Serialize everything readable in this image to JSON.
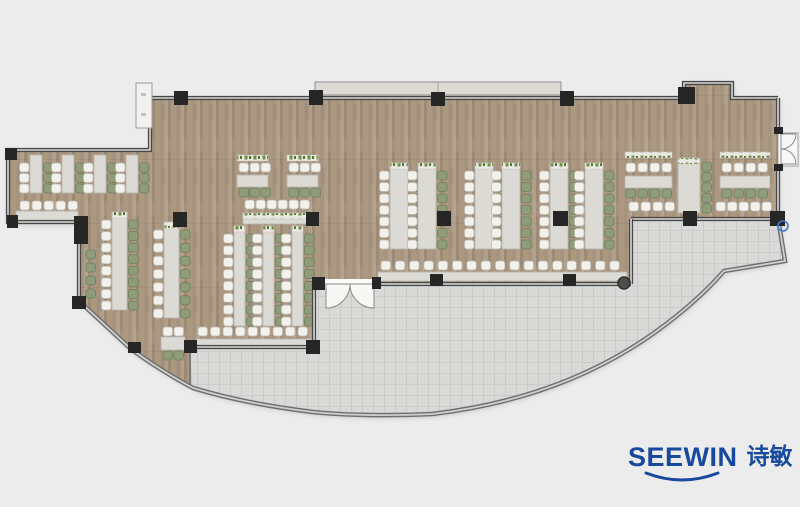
{
  "logo": {
    "brand": "SEEWIN",
    "brand_cn": "诗敏",
    "color": "#17499E"
  },
  "floorplan": {
    "width": 800,
    "height": 507,
    "colors": {
      "background": "#ececec",
      "wood1": "#a7947f",
      "wood2": "#b19f89",
      "wood3": "#9d8a76",
      "wood4": "#ab987f",
      "tile": "#d9d9d7",
      "tile_line": "#c7c7c5",
      "wall_dark": "#474747",
      "wall_core": "#d8d8d6",
      "facade": "#6e6e6e",
      "facade_core": "#cfcfcd",
      "column": "#262626",
      "table_fill": "#dcdad4",
      "table_edge": "#b7b5af",
      "chair_white": "#f3f1ec",
      "chair_white_edge": "#bdbbb5",
      "chair_green": "#8e9c79",
      "chair_green_edge": "#6f7f5a",
      "plant_base": "#eae8e2",
      "plant_green": "#6d8f3f",
      "plant_dark": "#4e7030",
      "canopy": "#dcdad3",
      "canopy_edge": "#8f8f8d",
      "door_leaf": "#f8f7f5",
      "door_edge": "#8a8a88",
      "accent_blue": "#3b7bd4"
    },
    "paths": {
      "dining": "M150,98 H684 V83 H732 V98 H778 V219 H631 V284 H314 V347 H190 V386 Q160,370 131,349 L79,301 V222 H8 V150 H150 Z",
      "terrace": "M190,348 H313 V284 H631 V220 H778 L784,261 L724,271 Q696,303 654,333 Q561,399 432,414 Q363,417 313,412 Q246,404 193,388 Z",
      "facade": "M79,301 L131,349 Q161,371 193,388 Q246,404 313,412 Q363,417 432,414 Q561,399 654,333 Q696,303 724,271 L785,261 L778,218"
    },
    "walls": [
      {
        "d": "M150,98 H684 V83 H732 V98 H778"
      },
      {
        "d": "M778,98 V133"
      },
      {
        "d": "M778,166 V219"
      },
      {
        "d": "M778,219 H631"
      },
      {
        "d": "M631,219 V284"
      },
      {
        "d": "M631,284 H374"
      },
      {
        "d": "M325,284 H314"
      },
      {
        "d": "M314,284 V347"
      },
      {
        "d": "M314,347 H190"
      },
      {
        "d": "M190,347 V385",
        "thin": true
      },
      {
        "d": "M150,98 V150 H8 V222 H79 V301"
      }
    ],
    "canopy": {
      "x": 315,
      "y": 82,
      "w": 246,
      "h": 13,
      "seam": 438
    },
    "fixture": {
      "x": 136,
      "y": 83,
      "w": 16,
      "h": 45
    },
    "columns": [
      [
        174,
        91,
        14,
        14
      ],
      [
        309,
        90,
        14,
        15
      ],
      [
        431,
        92,
        14,
        14
      ],
      [
        560,
        91,
        14,
        15
      ],
      [
        678,
        87,
        17,
        17
      ],
      [
        173,
        212,
        14,
        15
      ],
      [
        306,
        212,
        13,
        14
      ],
      [
        437,
        211,
        14,
        15
      ],
      [
        553,
        211,
        15,
        15
      ],
      [
        683,
        211,
        14,
        15
      ],
      [
        770,
        211,
        15,
        15
      ],
      [
        430,
        274,
        13,
        12
      ],
      [
        563,
        274,
        13,
        12
      ],
      [
        184,
        340,
        13,
        13
      ],
      [
        306,
        340,
        14,
        14
      ],
      [
        128,
        342,
        13,
        11
      ],
      [
        5,
        148,
        12,
        12
      ],
      [
        7,
        215,
        11,
        13
      ],
      [
        74,
        216,
        14,
        28
      ],
      [
        72,
        296,
        14,
        13
      ],
      [
        312,
        277,
        13,
        13
      ],
      [
        372,
        277,
        9,
        12
      ],
      [
        774,
        127,
        9,
        7
      ],
      [
        774,
        164,
        9,
        7
      ]
    ],
    "round_column": {
      "cx": 624,
      "cy": 283,
      "r": 6
    },
    "handle": {
      "cx": 783,
      "cy": 226,
      "r": 5
    },
    "doors": {
      "south_opening": {
        "x": 325,
        "y": 279,
        "w": 49,
        "h": 10
      },
      "south_leaves": [
        "M350,284 A24,24 0 0 1 326,308 L326,284 Z",
        "M350,284 A24,24 0 0 0 374,308 L374,284 Z"
      ],
      "right_opening": {
        "x": 778,
        "y": 133,
        "w": 20,
        "h": 33
      },
      "right_leaves": [
        "M781,149 A15,15 0 0 0 796,134 L781,134 Z",
        "M781,149 A15,15 0 0 1 796,164 L781,164 Z"
      ]
    },
    "vtables": [
      {
        "x": 30,
        "y": 155,
        "h": 38,
        "tw": 12,
        "s": 3
      },
      {
        "x": 62,
        "y": 155,
        "h": 38,
        "tw": 12,
        "s": 3
      },
      {
        "x": 94,
        "y": 155,
        "h": 38,
        "tw": 12,
        "s": 3
      },
      {
        "x": 126,
        "y": 155,
        "h": 38,
        "tw": 12,
        "s": 3
      },
      {
        "x": 112,
        "y": 212,
        "h": 98,
        "tw": 15,
        "s": 8,
        "plants": true
      },
      {
        "x": 164,
        "y": 222,
        "h": 96,
        "tw": 15,
        "s": 7,
        "plants": true
      },
      {
        "x": 234,
        "y": 226,
        "h": 100,
        "tw": 11,
        "s": 8,
        "plants": true
      },
      {
        "x": 263,
        "y": 226,
        "h": 100,
        "tw": 11,
        "s": 8,
        "plants": true
      },
      {
        "x": 292,
        "y": 226,
        "h": 100,
        "tw": 11,
        "s": 8,
        "plants": true
      },
      {
        "x": 390,
        "y": 163,
        "h": 86,
        "tw": 18,
        "s": 7,
        "plants": true
      },
      {
        "x": 418,
        "y": 163,
        "h": 86,
        "tw": 18,
        "s": 7,
        "plants": true
      },
      {
        "x": 475,
        "y": 163,
        "h": 86,
        "tw": 18,
        "s": 7,
        "plants": true
      },
      {
        "x": 502,
        "y": 163,
        "h": 86,
        "tw": 18,
        "s": 7,
        "plants": true
      },
      {
        "x": 550,
        "y": 163,
        "h": 86,
        "tw": 18,
        "s": 7,
        "plants": true
      },
      {
        "x": 585,
        "y": 163,
        "h": 86,
        "tw": 18,
        "s": 7,
        "plants": true
      }
    ],
    "tables": [
      {
        "x": 16,
        "y": 211,
        "w": 62,
        "h": 10
      },
      {
        "x": 196,
        "y": 339,
        "w": 116,
        "h": 9
      },
      {
        "x": 378,
        "y": 272,
        "w": 249,
        "h": 9
      },
      {
        "x": 625,
        "y": 176,
        "w": 47,
        "h": 12
      },
      {
        "x": 720,
        "y": 176,
        "w": 50,
        "h": 12
      },
      {
        "x": 243,
        "y": 213,
        "w": 68,
        "h": 11,
        "plants": true
      },
      {
        "x": 237,
        "y": 175,
        "w": 31,
        "h": 12
      },
      {
        "x": 287,
        "y": 175,
        "w": 31,
        "h": 12
      },
      {
        "x": 678,
        "y": 158,
        "w": 22,
        "h": 55,
        "plants": true
      },
      {
        "x": 161,
        "y": 337,
        "w": 24,
        "h": 13
      }
    ],
    "plant_strips": [
      {
        "x": 237,
        "y": 155,
        "w": 31
      },
      {
        "x": 287,
        "y": 155,
        "w": 31
      },
      {
        "x": 625,
        "y": 152,
        "w": 47
      },
      {
        "x": 720,
        "y": 152,
        "w": 50
      }
    ],
    "chair_rows": [
      {
        "x": 20,
        "y": 201,
        "n": 5,
        "p": 12,
        "c": "white"
      },
      {
        "x": 198,
        "y": 327,
        "n": 9,
        "p": 12.5,
        "c": "white"
      },
      {
        "x": 245,
        "y": 200,
        "n": 6,
        "p": 11,
        "c": "white"
      },
      {
        "x": 381,
        "y": 261,
        "n": 17,
        "p": 14.3,
        "c": "white"
      },
      {
        "x": 626,
        "y": 163,
        "n": 4,
        "p": 12,
        "c": "white"
      },
      {
        "x": 626,
        "y": 189,
        "n": 4,
        "p": 12,
        "c": "green"
      },
      {
        "x": 629,
        "y": 202,
        "n": 4,
        "p": 12,
        "c": "white"
      },
      {
        "x": 722,
        "y": 163,
        "n": 4,
        "p": 12,
        "c": "white"
      },
      {
        "x": 722,
        "y": 189,
        "n": 4,
        "p": 12,
        "c": "green"
      },
      {
        "x": 716,
        "y": 202,
        "n": 5,
        "p": 11.5,
        "c": "white"
      },
      {
        "x": 239,
        "y": 163,
        "n": 3,
        "p": 11,
        "c": "white"
      },
      {
        "x": 239,
        "y": 188,
        "n": 3,
        "p": 11,
        "c": "green"
      },
      {
        "x": 289,
        "y": 163,
        "n": 3,
        "p": 11,
        "c": "white"
      },
      {
        "x": 289,
        "y": 188,
        "n": 3,
        "p": 11,
        "c": "green"
      },
      {
        "x": 163,
        "y": 327,
        "n": 2,
        "p": 11,
        "c": "white"
      },
      {
        "x": 163,
        "y": 351,
        "n": 2,
        "p": 11,
        "c": "green"
      },
      {
        "x": 702,
        "y": 162,
        "n": 5,
        "p": 10.5,
        "c": "green",
        "v": true
      },
      {
        "x": 86,
        "y": 250,
        "n": 4,
        "p": 13,
        "c": "green",
        "v": true
      }
    ]
  }
}
